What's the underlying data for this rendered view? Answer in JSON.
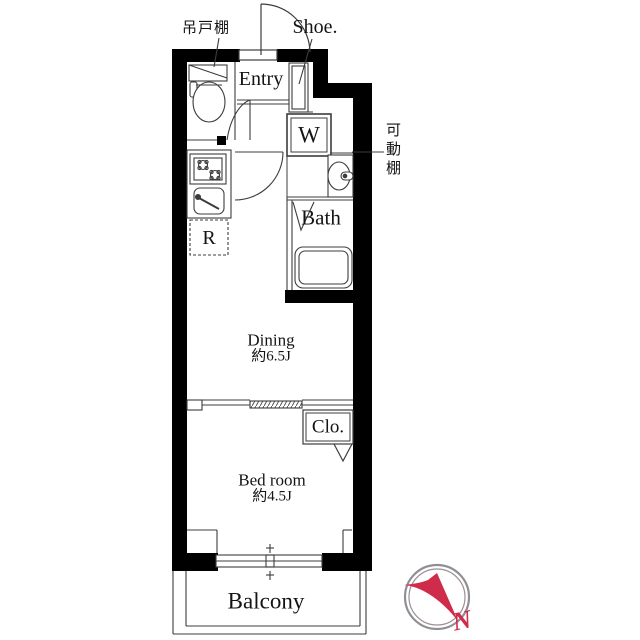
{
  "floorplan": {
    "annotations": {
      "hanging_cupboard": "吊戸棚",
      "shoe_closet": "Shoe.",
      "movable_shelf": "可動棚",
      "compass_north": "N"
    },
    "rooms": {
      "entry": "Entry",
      "dining": {
        "name": "Dining",
        "size": "約6.5J"
      },
      "bedroom": {
        "name": "Bed room",
        "size": "約4.5J"
      },
      "bath": "Bath",
      "closet": "Clo.",
      "balcony": "Balcony"
    },
    "fixtures": {
      "washing_machine": "W",
      "refrigerator": "R"
    },
    "colors": {
      "wall": "#000000",
      "line": "#3c3c3c",
      "compass_red": "#cf2b4b",
      "compass_ring": "#8f8f96",
      "background": "#ffffff"
    }
  }
}
